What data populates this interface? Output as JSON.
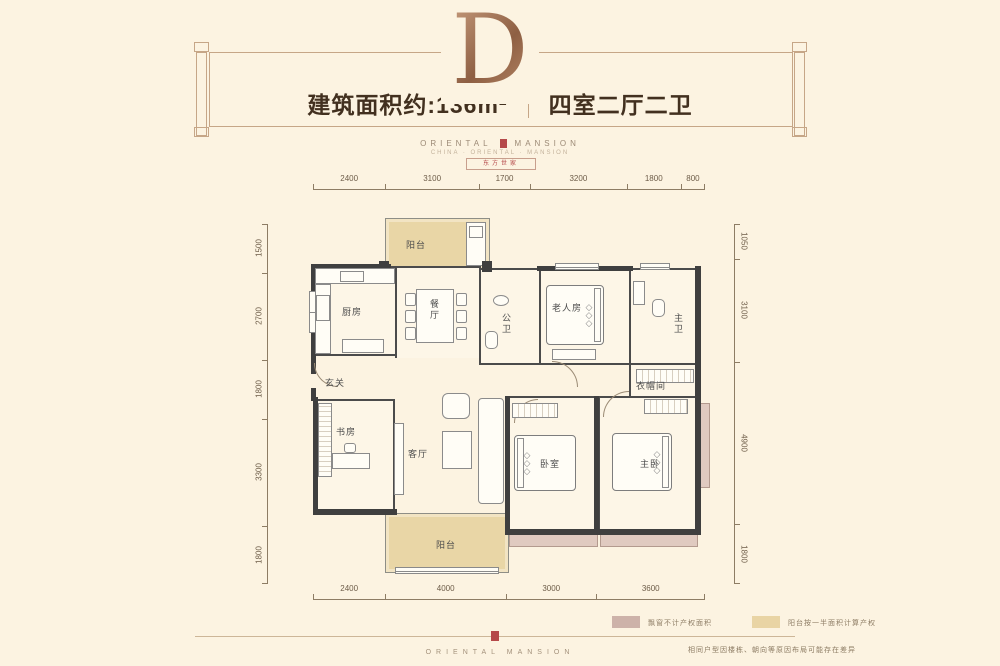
{
  "header": {
    "type_letter": "D",
    "area_label": "建筑面积约:136m²",
    "layout_label": "四室二厅二卫",
    "brand_left": "ORIENTAL",
    "brand_right": "MANSION",
    "brand_sub": "CHINA · ORIENTAL · MANSION",
    "brand_seal": "东方世家"
  },
  "dims": {
    "top": [
      "2400",
      "3100",
      "1700",
      "3200",
      "1800",
      "800"
    ],
    "bottom": [
      "2400",
      "4000",
      "3000",
      "3600"
    ],
    "left": [
      "1500",
      "2700",
      "1800",
      "3300",
      "1800"
    ],
    "right": [
      "1050",
      "3100",
      "4900",
      "1800"
    ]
  },
  "rooms": {
    "balcony_top": "阳台",
    "kitchen": "厨房",
    "dining": "餐厅",
    "guest_bath": "公卫",
    "elder_room": "老人房",
    "master_bath": "主卫",
    "cloakroom": "衣帽间",
    "foyer": "玄关",
    "study": "书房",
    "living": "客厅",
    "bedroom": "卧室",
    "master_bedroom": "主卧",
    "balcony_bottom": "阳台"
  },
  "legend": [
    {
      "color": "#cdb2a9",
      "label": "飘窗不计产权面积"
    },
    {
      "color": "#e9d4a4",
      "label": "阳台按一半面积计算产权"
    }
  ],
  "footer": {
    "brand": "ORIENTAL MANSION",
    "disclaimer": "相同户型因楼栋、朝向等原因布局可能存在差异"
  },
  "colors": {
    "background": "#fcf3e1",
    "wall": "#3f3f3f",
    "balcony_fill": "#e9d6a6",
    "bay_window_fill": "#e0cac0",
    "copper": "#a9745a",
    "accent_red": "#b5494a",
    "frame_line": "#c6a687"
  }
}
